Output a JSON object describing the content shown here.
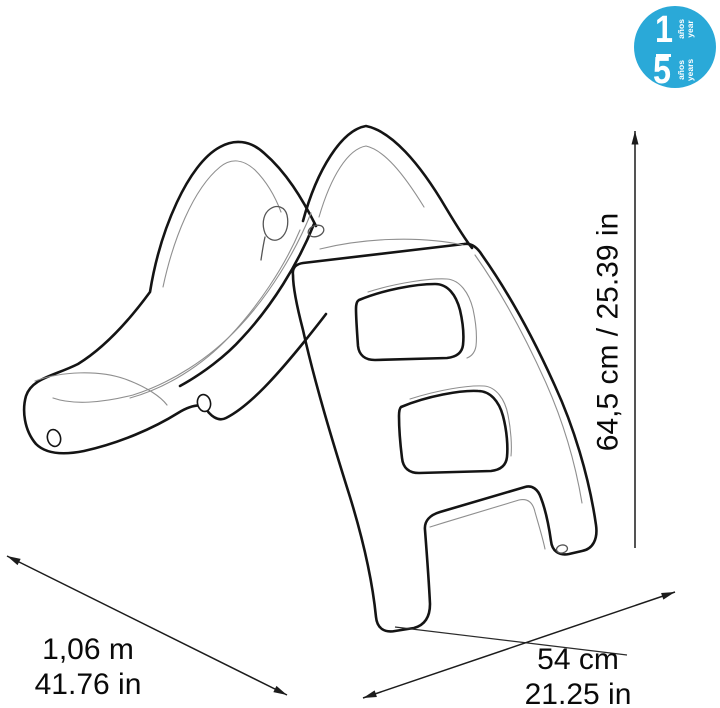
{
  "page": {
    "background": "#ffffff"
  },
  "age_badge": {
    "min_number": "1",
    "min_unit_line1": "años",
    "min_unit_line2": "year",
    "max_number": "5",
    "max_unit_line1": "años",
    "max_unit_line2": "years",
    "background_color": "#2aa9d8",
    "text_color": "#ffffff"
  },
  "dimensions": {
    "height_label": "64,5 cm / 25.39 in",
    "length_label_metric": "1,06 m",
    "length_label_imperial": "41.76 in",
    "depth_label_metric": "54 cm",
    "depth_label_imperial": "21.25 in"
  },
  "illustration": {
    "subject": "toddler slide line drawing",
    "stroke_color": "#141414",
    "detail_color": "#8f8f8f"
  }
}
